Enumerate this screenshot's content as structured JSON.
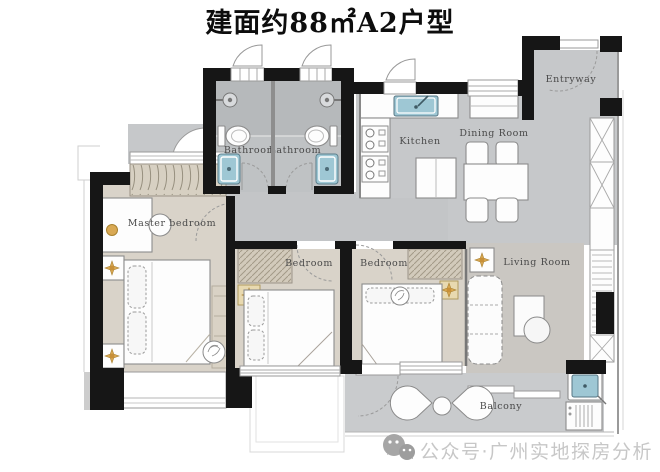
{
  "title": "建面约88㎡A2户型",
  "watermark": {
    "icon": "wechat-icon",
    "text": "公众号·广州实地探房分析"
  },
  "rooms": {
    "master_bedroom": "Master bedroom",
    "bathroom_1": "Bathroom",
    "bathroom_2": "Bathroom",
    "kitchen": "Kitchen",
    "dining_room": "Dining Room",
    "entryway": "Entryway",
    "bedroom_1": "Bedroom",
    "bedroom_2": "Bedroom",
    "living_room": "Living Room",
    "balcony": "Balcony"
  },
  "colors": {
    "wall": "#161616",
    "floor_gray": "#c6c8ca",
    "floor_wood": "#d9d3c9",
    "bath_tile": "#bfc2c4",
    "fixture_teal": "#9ec7d4",
    "accent_gold": "#d9a954",
    "label_text": "#4a4a4a",
    "watermark_text": "#c7c7c7"
  }
}
